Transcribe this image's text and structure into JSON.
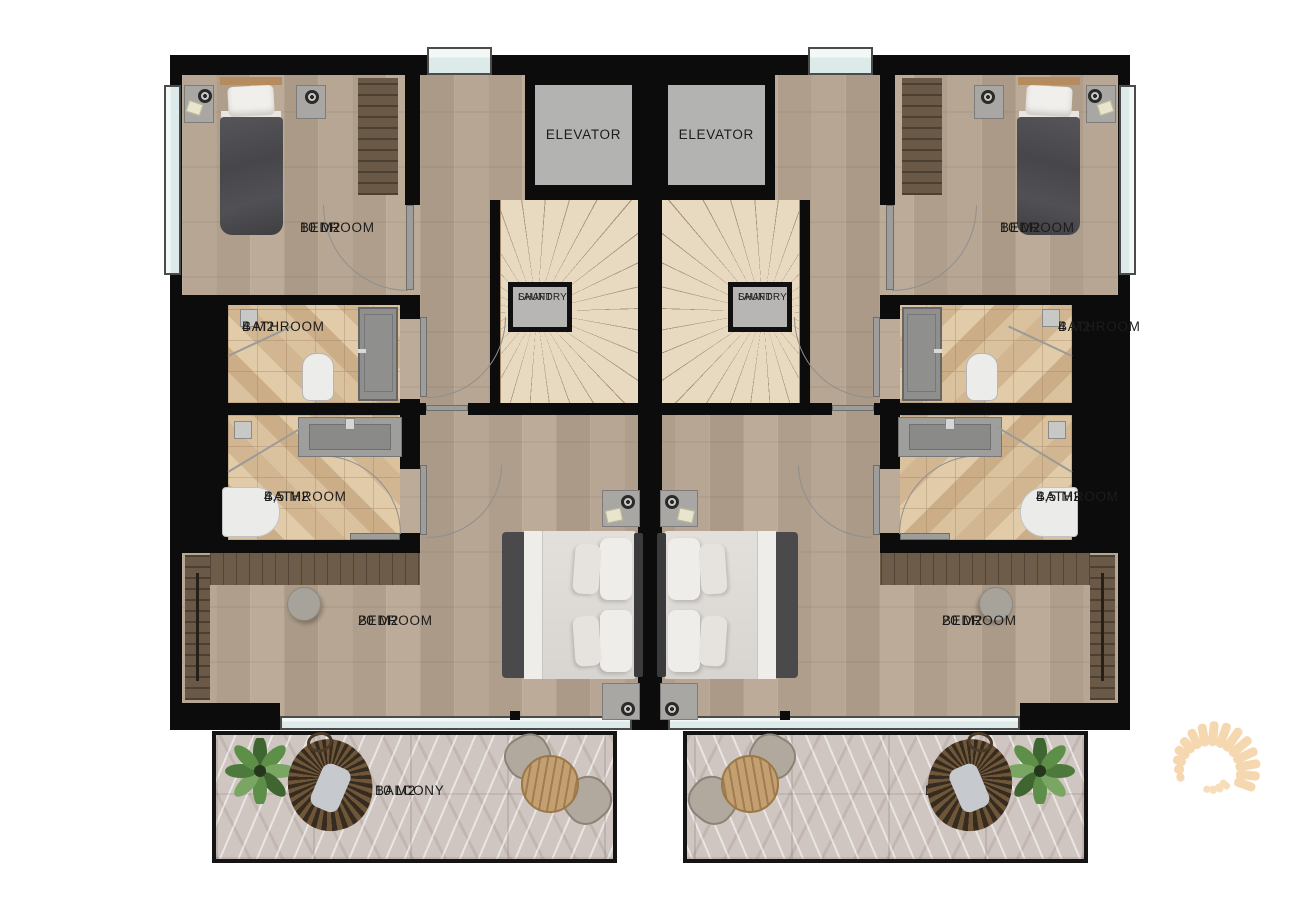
{
  "labels": {
    "elevator": "ELEVATOR",
    "laundry_line1": "LAUNDRY",
    "laundry_line2": "SHAFT"
  },
  "rooms": {
    "bedroom_small": {
      "name": "BEDROOM",
      "area": "10 M2"
    },
    "bathroom_small": {
      "name": "BATHROOM",
      "area": "4 M2"
    },
    "bathroom_large": {
      "name": "BATHROOM",
      "area": "4,5 M2"
    },
    "bedroom_large": {
      "name": "BEDROOM",
      "area": "20 M2"
    },
    "balcony": {
      "name": "BALCONY",
      "area": "10 M2"
    }
  },
  "colors": {
    "wall": "#0c0c0c",
    "wood_floor": "#b3a28f",
    "tile_floor": "#d6bb96",
    "marble_floor": "#cfc6c1",
    "window": "#dcebe9",
    "elevator_cab": "#b3b3b1",
    "stairs": "#e8d9c1",
    "dark_wood": "#6a5947",
    "sun_logo": "#f6d8b0"
  }
}
